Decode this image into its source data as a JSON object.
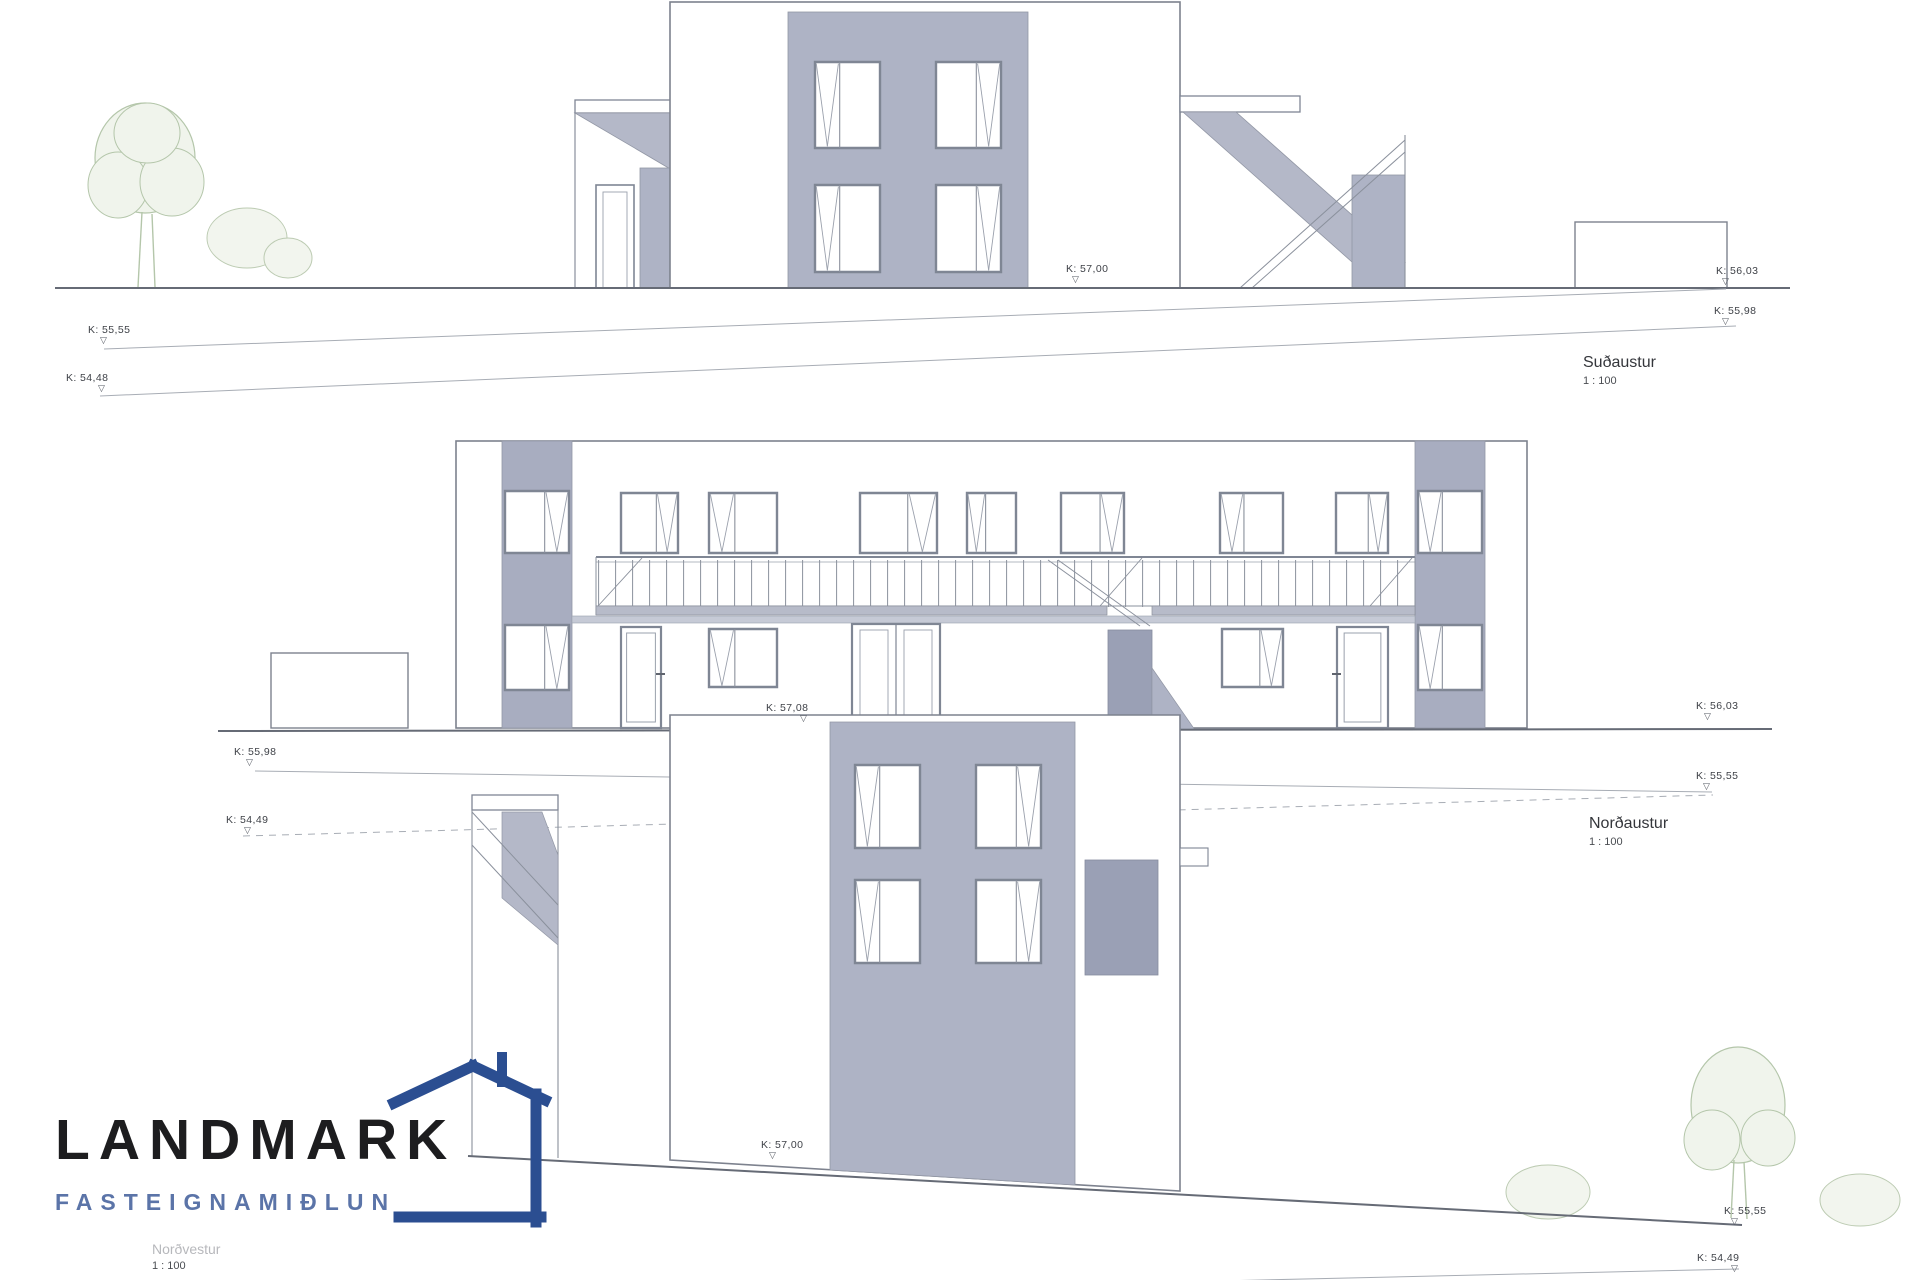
{
  "icons": {
    "benchmark": "▽"
  },
  "colors": {
    "panel_gray": "#aeb3c5",
    "pilaster_gray": "#a8adc0",
    "door_gray": "#9aa0b5",
    "slab_gray": "#b7bbc9",
    "ground_line": "#666b76",
    "terrain_line": "#a8adb5",
    "tree_green": "#b4c6aa",
    "logo_blue": "#2b4e91",
    "logo_text_blue": "#5b74a8",
    "logo_black": "#1d1d1f"
  },
  "elevations": [
    {
      "name": "sudaustur",
      "caption": "Suðaustur",
      "scale_label": "1 : 100",
      "markers": [
        {
          "id": "k5700",
          "label": "K: 57,00"
        },
        {
          "id": "k5603",
          "label": "K: 56,03"
        },
        {
          "id": "k5598",
          "label": "K: 55,98"
        },
        {
          "id": "k5555",
          "label": "K: 55,55"
        },
        {
          "id": "k5448",
          "label": "K: 54,48"
        }
      ]
    },
    {
      "name": "nordaustur",
      "caption": "Norðaustur",
      "scale_label": "1 : 100",
      "markers": [
        {
          "id": "k5708",
          "label": "K: 57,08"
        },
        {
          "id": "k5598",
          "label": "K: 55,98"
        },
        {
          "id": "k5449",
          "label": "K: 54,49"
        },
        {
          "id": "k5603",
          "label": "K: 56,03"
        },
        {
          "id": "k5555",
          "label": "K: 55,55"
        }
      ]
    },
    {
      "name": "nordvestur",
      "caption": "Norðvestur",
      "scale_label": "1 : 100",
      "markers": [
        {
          "id": "k5700",
          "label": "K: 57,00"
        },
        {
          "id": "k5555",
          "label": "K: 55,55"
        },
        {
          "id": "k5449",
          "label": "K: 54,49"
        }
      ]
    }
  ],
  "logo": {
    "name": "LANDMARK",
    "subtitle": "FASTEIGNAMIÐLUN"
  }
}
